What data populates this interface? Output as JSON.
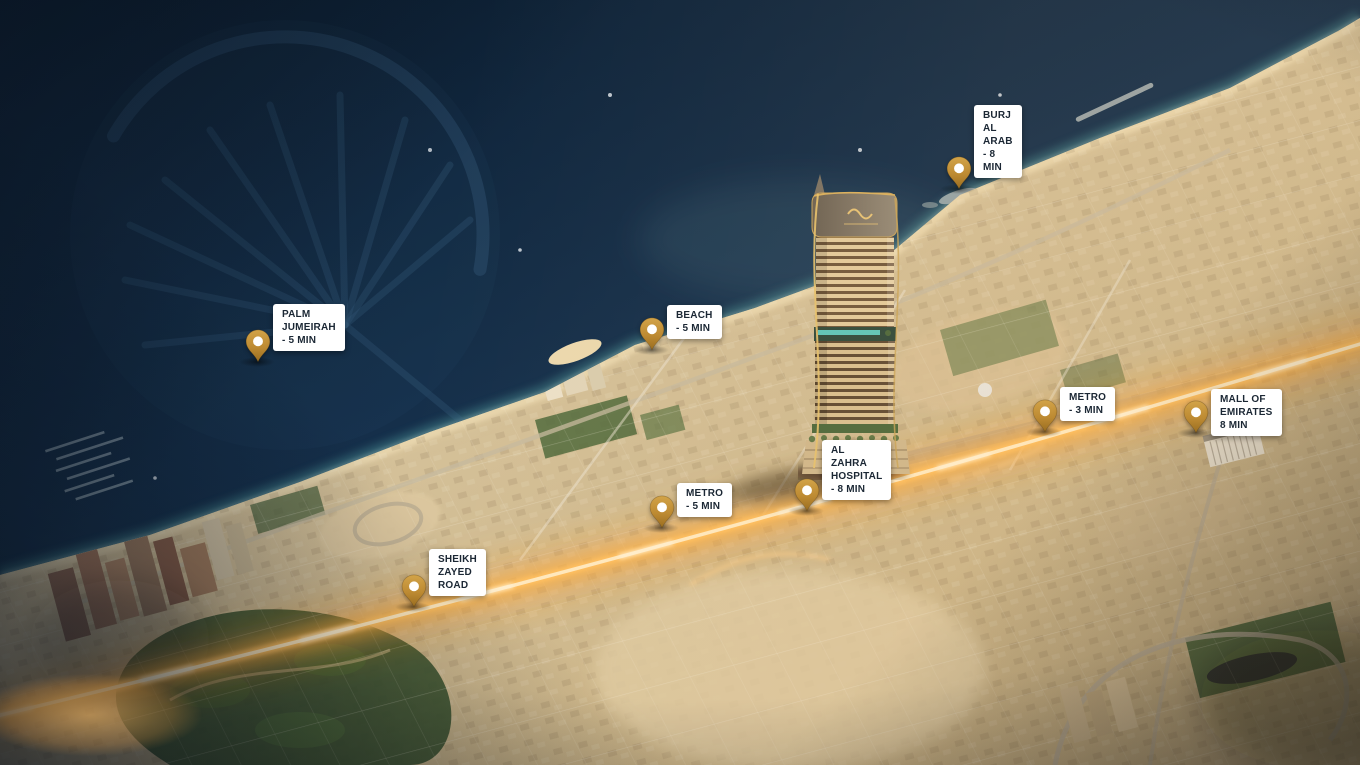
{
  "markers": [
    {
      "name": "burj-al-arab",
      "label": "BURJ AL ARAB - 8 MIN"
    },
    {
      "name": "palm-jumeirah",
      "label": "PALM JUMEIRAH - 5 MIN"
    },
    {
      "name": "beach",
      "label": "BEACH - 5 MIN"
    },
    {
      "name": "metro-3min",
      "label": "METRO - 3 MIN"
    },
    {
      "name": "mall-of-emirates",
      "label": "MALL OF EMIRATES\n8 MIN"
    },
    {
      "name": "al-zahra-hospital",
      "label": "AL ZAHRA HOSPITAL - 8 MIN"
    },
    {
      "name": "metro-5min",
      "label": "METRO - 5 MIN"
    },
    {
      "name": "sheikh-zayed-road",
      "label": "SHEIKH ZAYED ROAD"
    }
  ],
  "icons": {
    "pin": "location-pin"
  },
  "colors": {
    "pin_gold": "#c08a36",
    "pin_gold_dark": "#96691f",
    "label_bg": "#ffffff",
    "label_text": "#1b2734",
    "sea_deep": "#0f2133",
    "sea_shore": "#2e5a68",
    "sand": "#d7c49e",
    "greenery": "#4c6239",
    "road_glow": "#ffb347",
    "road_core": "#ffe9bf"
  }
}
